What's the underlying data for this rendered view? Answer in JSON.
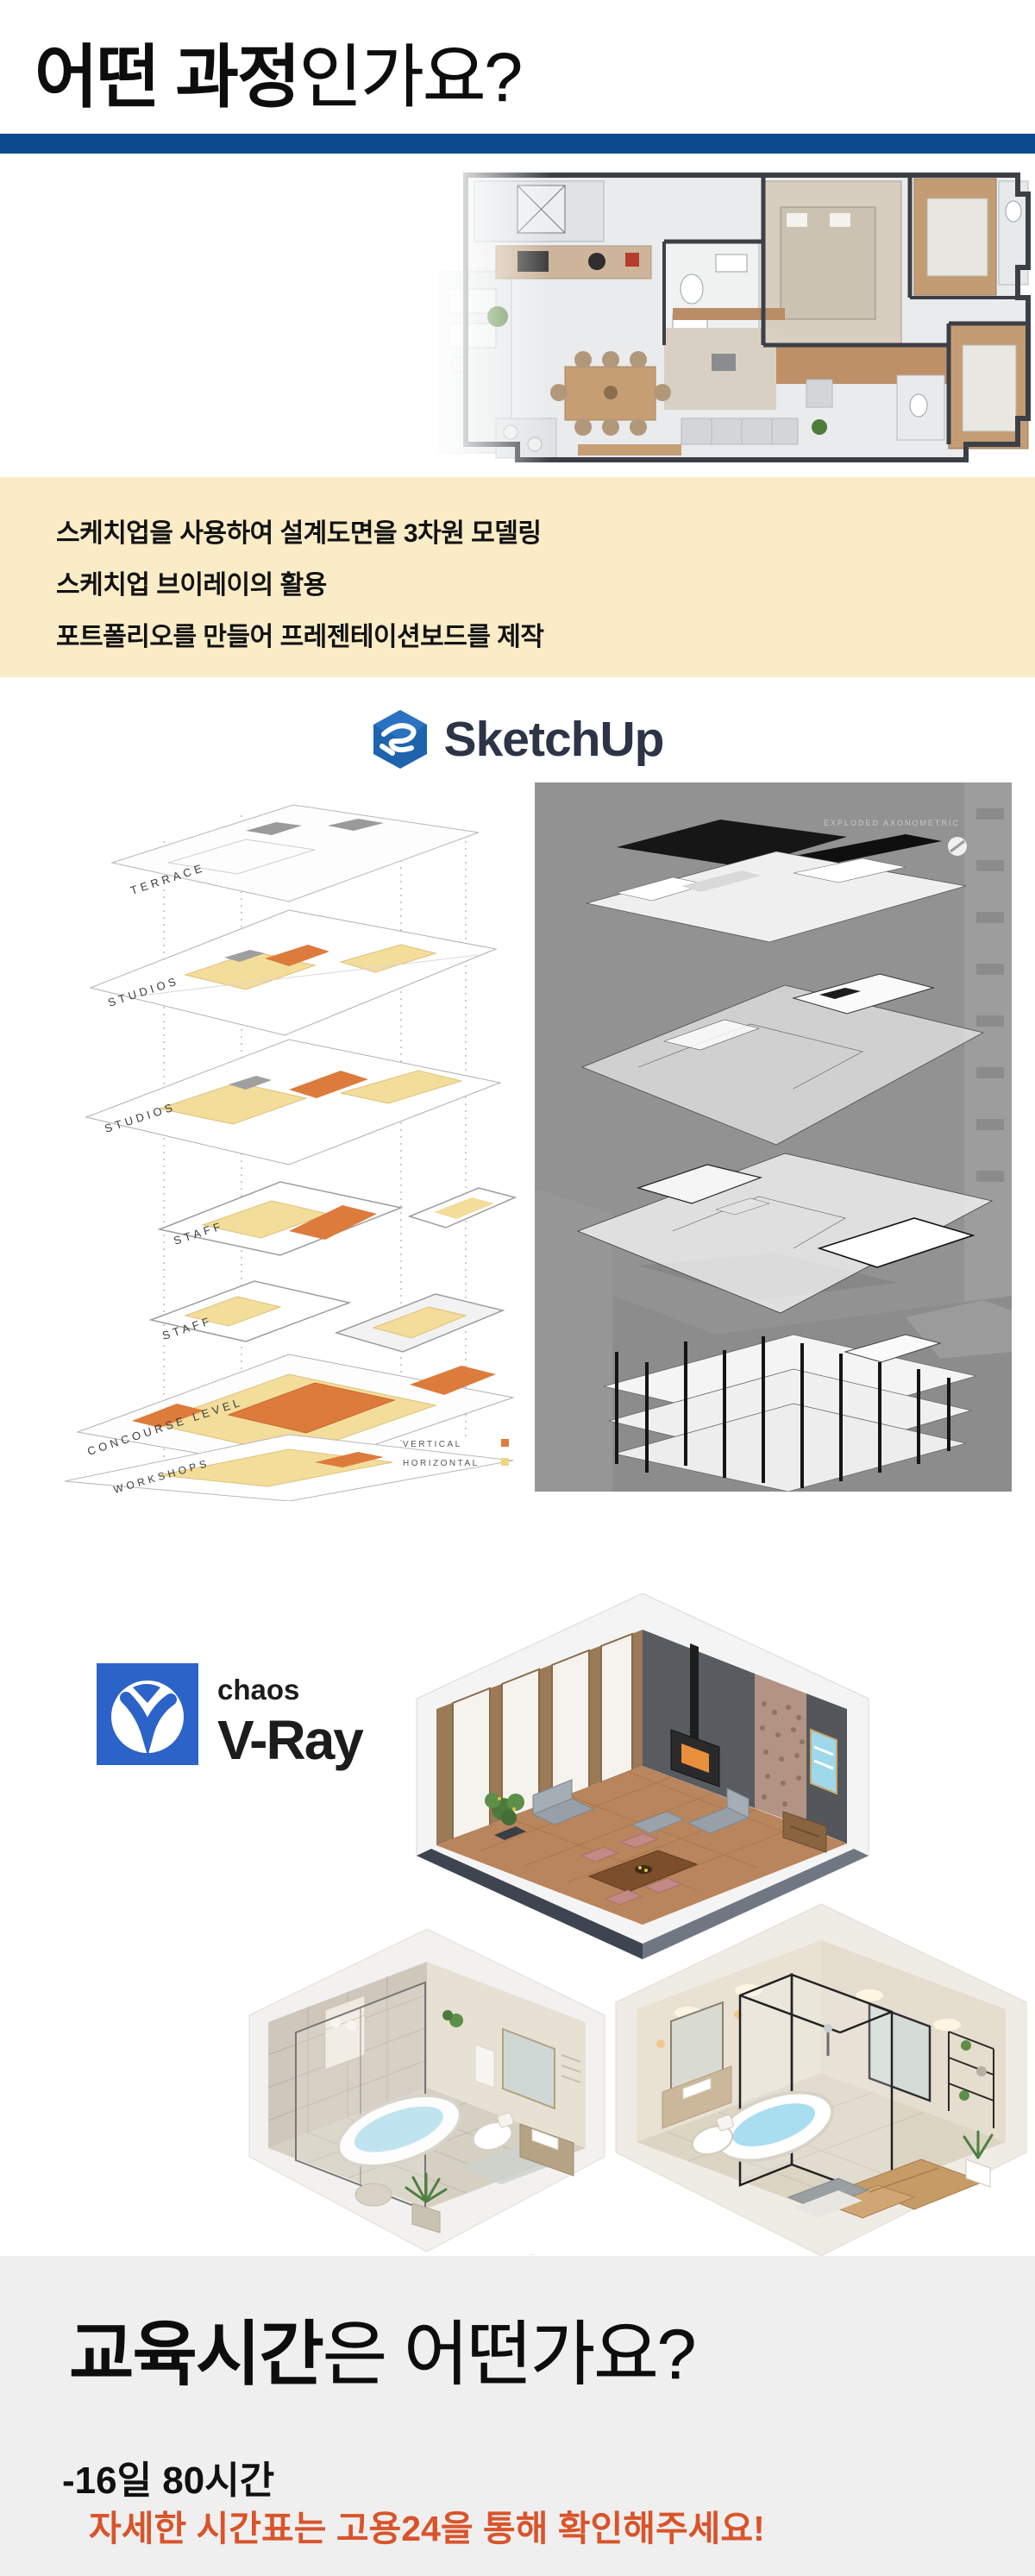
{
  "header": {
    "title_bold": "어떤 과정",
    "title_light": "인가요?",
    "underline_color": "#0a4a8e"
  },
  "features": {
    "bg_color": "#f9ecc6",
    "items": [
      "스케치업을 사용하여 설계도면을 3차원 모델링",
      "스케치업 브이레이의 활용",
      "포트폴리오를 만들어 프레젠테이션보드를 제작"
    ]
  },
  "sketchup": {
    "label": "SketchUp",
    "icon_color": "#1d63ae",
    "text_color": "#2e3447"
  },
  "left_diagram": {
    "labels": [
      "TERRACE",
      "STUDIOS",
      "STUDIOS",
      "STAFF",
      "STAFF",
      "CONCOURSE LEVEL",
      "WORKSHOPS"
    ],
    "legend": [
      {
        "label": "VERTICAL",
        "color": "#dd7b3c"
      },
      {
        "label": "HORIZONTAL",
        "color": "#f0d488"
      }
    ],
    "highlight_yellow": "#f3dd9a",
    "highlight_orange": "#dd7b3c"
  },
  "right_diagram": {
    "caption": "EXPLODED AXONOMETRIC",
    "bg_color": "#929292"
  },
  "vray": {
    "brand": "chaos",
    "product": "V-Ray",
    "square_color": "#2c63c8"
  },
  "schedule": {
    "bg_color": "#efefef",
    "title_bold": "교육시간",
    "title_light": "은 어떤가요?",
    "duration": "-16일 80시간",
    "notice": "자세한 시간표는 고용24을 통해 확인해주세요!",
    "notice_color": "#d9542b"
  }
}
